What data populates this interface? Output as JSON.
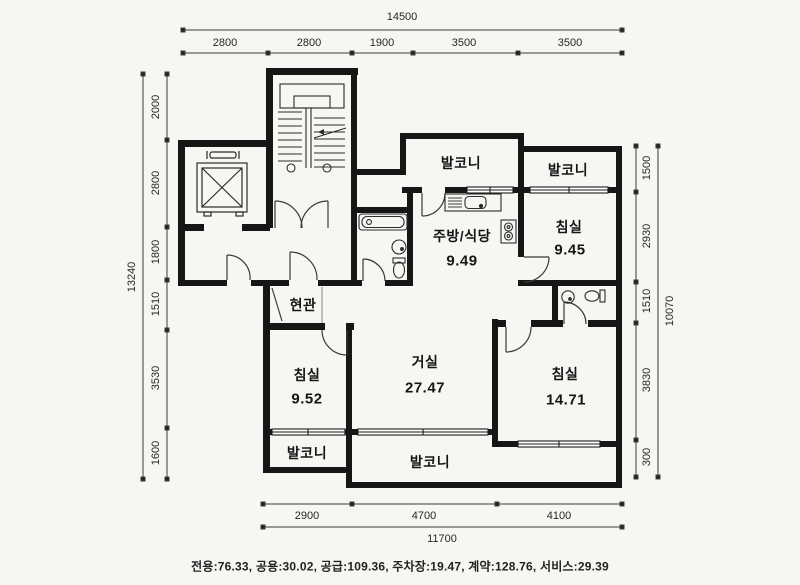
{
  "floor_plan": {
    "rooms": {
      "balcony_top_center": {
        "label": "발코니"
      },
      "balcony_top_right": {
        "label": "발코니"
      },
      "kitchen_dining": {
        "label": "주방/식당",
        "area": "9.49"
      },
      "bedroom_top_right": {
        "label": "침실",
        "area": "9.45"
      },
      "entrance": {
        "label": "현관"
      },
      "bedroom_left": {
        "label": "침실",
        "area": "9.52"
      },
      "living_room": {
        "label": "거실",
        "area": "27.47"
      },
      "bedroom_bottom_right": {
        "label": "침실",
        "area": "14.71"
      },
      "balcony_bottom_left": {
        "label": "발코니"
      },
      "balcony_bottom_center": {
        "label": "발코니"
      }
    },
    "dimensions": {
      "top": {
        "total": "14500",
        "segments": [
          "2800",
          "2800",
          "1900",
          "3500",
          "3500"
        ]
      },
      "left": {
        "total": "13240",
        "segments": [
          "2000",
          "2800",
          "1800",
          "1510",
          "3530",
          "1600"
        ]
      },
      "right": {
        "total": "10070",
        "segments": [
          "1500",
          "2930",
          "1510",
          "3830",
          "300"
        ]
      },
      "bottom": {
        "total": "11700",
        "segments": [
          "2900",
          "4700",
          "4100"
        ]
      }
    },
    "summary": {
      "line": "전용:76.33, 공용:30.02, 공급:109.36, 주차장:19.47, 계약:128.76, 서비스:29.39",
      "items": [
        {
          "label": "전용",
          "value": "76.33"
        },
        {
          "label": "공용",
          "value": "30.02"
        },
        {
          "label": "공급",
          "value": "109.36"
        },
        {
          "label": "주차장",
          "value": "19.47"
        },
        {
          "label": "계약",
          "value": "128.76"
        },
        {
          "label": "서비스",
          "value": "29.39"
        }
      ]
    }
  }
}
